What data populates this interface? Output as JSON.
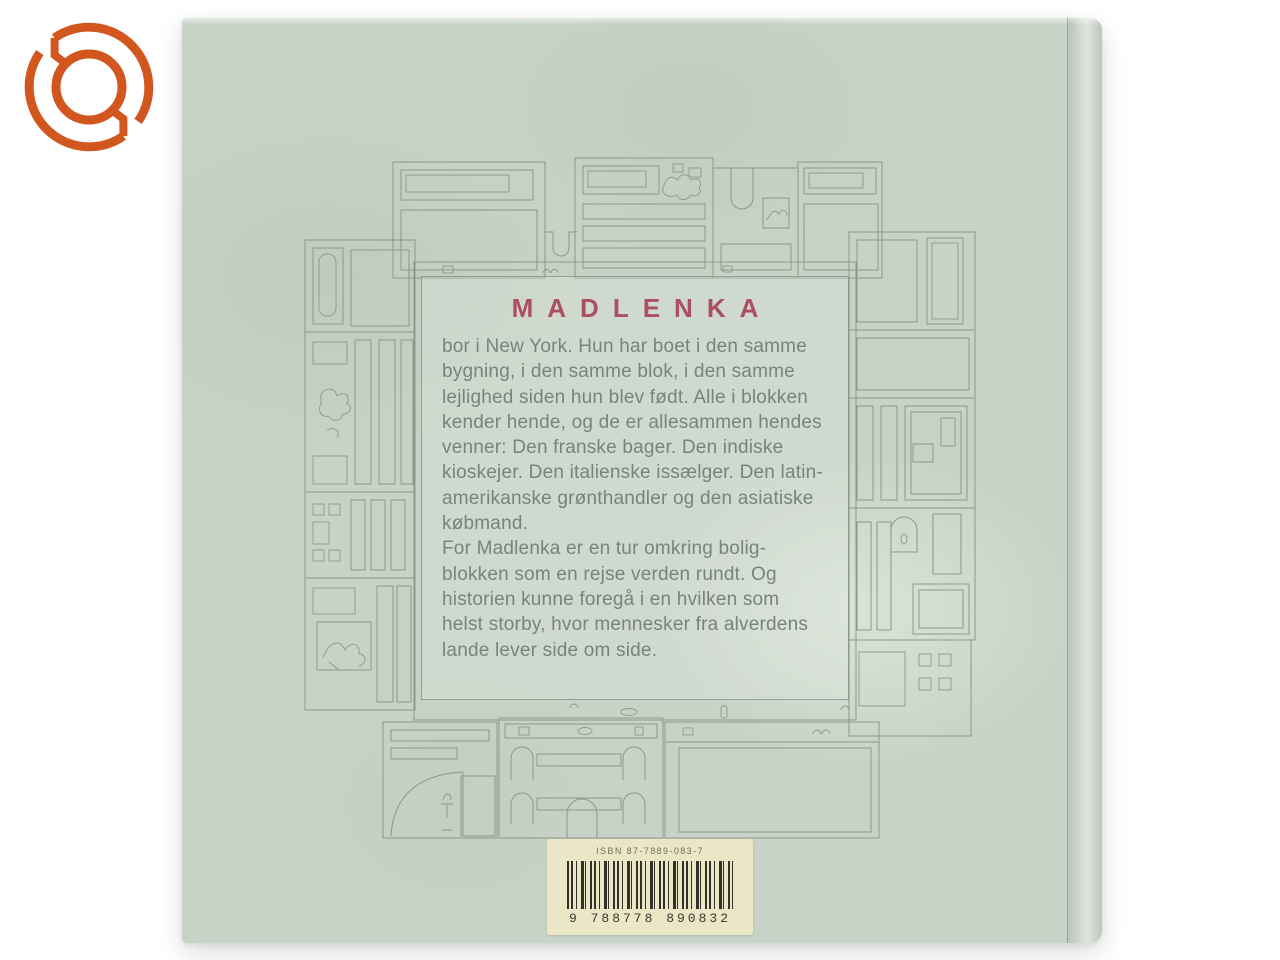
{
  "scene": {
    "background_color": "#ffffff"
  },
  "watermark_logo": {
    "name": "orange-ring-logo",
    "color": "#d2571f"
  },
  "book_cover": {
    "base_color": "#c8d3c7",
    "title": "MADLENKA",
    "title_color": "#ad4f63",
    "body_lines": [
      "bor i New York. Hun har boet i den samme",
      "bygning, i den samme blok, i den samme",
      "lejlighed siden hun blev født. Alle i blokken",
      "kender hende, og de er allesammen hendes",
      "venner: Den franske bager. Den indiske",
      "kioskejer. Den italienske issælger. Den latin-",
      "amerikanske grønthandler og den asiatiske",
      "købmand.",
      "For Madlenka er en tur omkring bolig-",
      "blokken som en rejse verden rundt. Og",
      "historien kunne foregå i en hvilken som",
      "helst storby, hvor mennesker fra alverdens",
      "lande lever side om side."
    ]
  },
  "barcode_sticker": {
    "isbn_text": "ISBN 87-7889-083-7",
    "ean_text": "9 788778 890832",
    "sticker_color": "#eae6c6"
  }
}
